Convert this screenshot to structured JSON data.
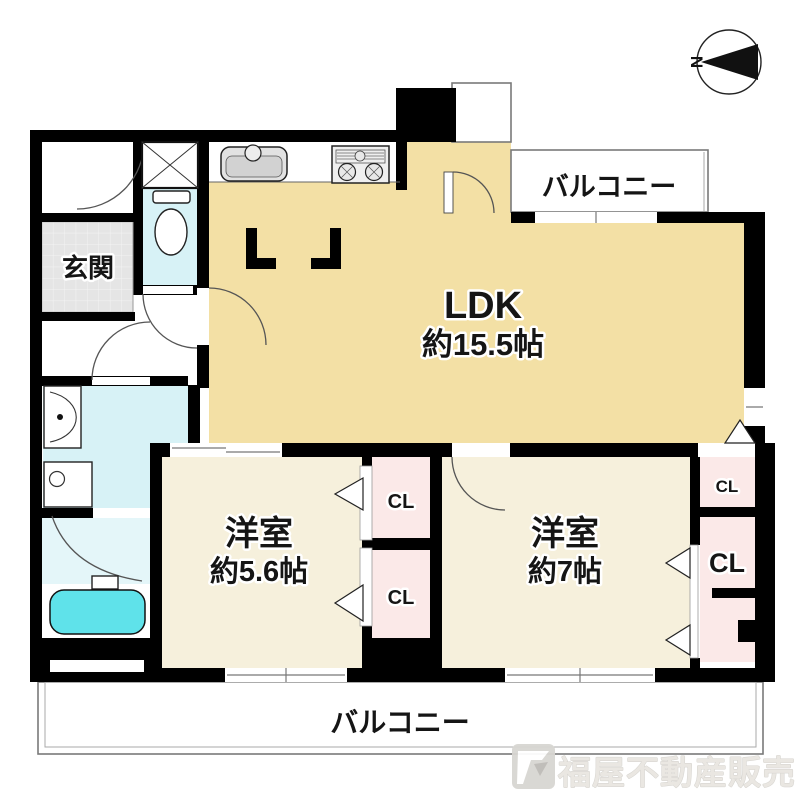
{
  "floor_plan": {
    "entrance": {
      "label": "玄関"
    },
    "ldk": {
      "label": "LDK",
      "size": "約15.5帖"
    },
    "bedroom_small": {
      "label": "洋室",
      "size": "約5.6帖"
    },
    "bedroom_large": {
      "label": "洋室",
      "size": "約7帖"
    },
    "closet_label": "CL",
    "balcony_top": {
      "label": "バルコニー"
    },
    "balcony_bottom": {
      "label": "バルコニー"
    },
    "compass": {
      "north_label": "N"
    },
    "fixtures": [
      "kitchen-sink",
      "gas-stove",
      "toilet",
      "washbasin",
      "washing-machine",
      "bathtub",
      "shaft-box"
    ],
    "watermark": {
      "company": "福屋不動産販売"
    },
    "colors": {
      "wall": "#000000",
      "ldk": "#F3E0A5",
      "bedroom": "#F6F0DC",
      "closet": "#FBE9E8",
      "wet_area": "#D7F2F6",
      "shower": "#E4F6F9",
      "bathtub": "#5FE2EA",
      "entrance_tile": "#E5E5E5",
      "balcony_line": "#7A7A7A",
      "door_line": "#555555",
      "watermark": "#E9E6E1"
    }
  }
}
